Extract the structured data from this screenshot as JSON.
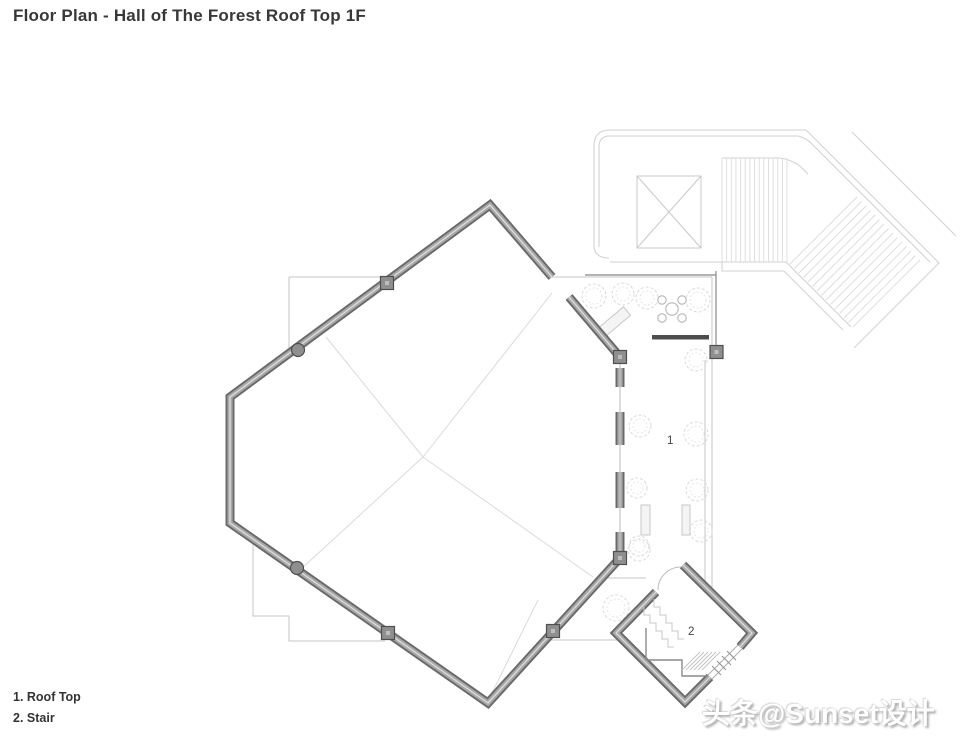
{
  "title": "Floor Plan - Hall of The Forest Roof Top 1F",
  "legend": {
    "items": [
      {
        "label": "1. Roof Top"
      },
      {
        "label": "2. Stair"
      }
    ]
  },
  "plan": {
    "room_labels": {
      "roof_top": "1",
      "stair": "2"
    }
  },
  "watermark": "头条@Sunset设计",
  "colors": {
    "wall_dark": "#696969",
    "wall_mid": "#a8a8a8",
    "wall_core": "#e0e0e0",
    "construction_line": "#c6c6c6",
    "walkway_line": "#d2d2d2",
    "tread_line": "#dcdcdc",
    "terrace_boundary": "#9a9a9a",
    "bench_dark": "#4d4d4d",
    "text": "#383838"
  }
}
